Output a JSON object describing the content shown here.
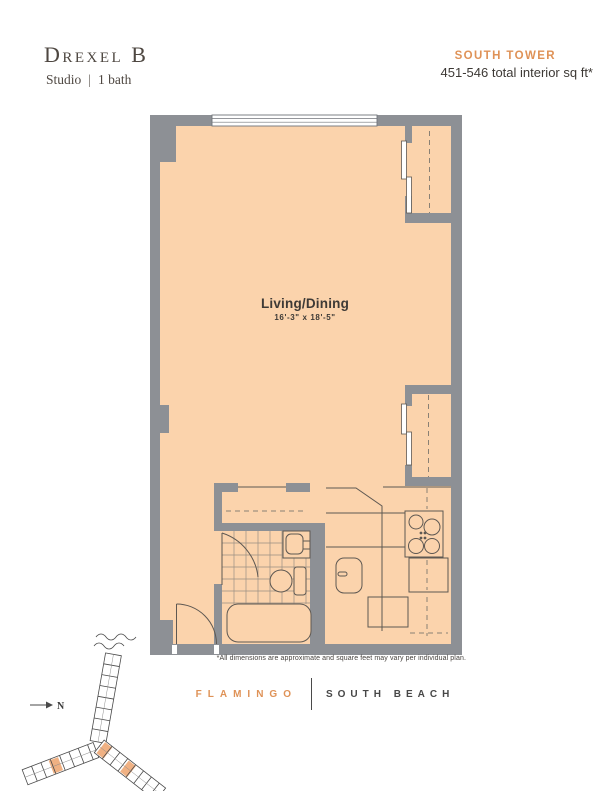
{
  "header": {
    "title": "Drexel B",
    "subtitle_type": "Studio",
    "subtitle_divider": "|",
    "subtitle_bath": "1 bath",
    "tower": "SOUTH TOWER",
    "sqft": "451-546 total interior sq ft*"
  },
  "plan": {
    "room_label": "Living/Dining",
    "room_dims": "16'-3\" x 18'-5\"",
    "footnote": "*All dimensions are approximate and square feet may vary per individual plan."
  },
  "site_map": {
    "north_label": "N"
  },
  "logo": {
    "left": "FLAMINGO",
    "right": "SOUTH BEACH"
  },
  "colors": {
    "floor": "#FBD3AC",
    "wall": "#8D9095",
    "accent": "#DF9257",
    "site_highlight": "#F0B183",
    "text_dark": "#3D3935"
  }
}
